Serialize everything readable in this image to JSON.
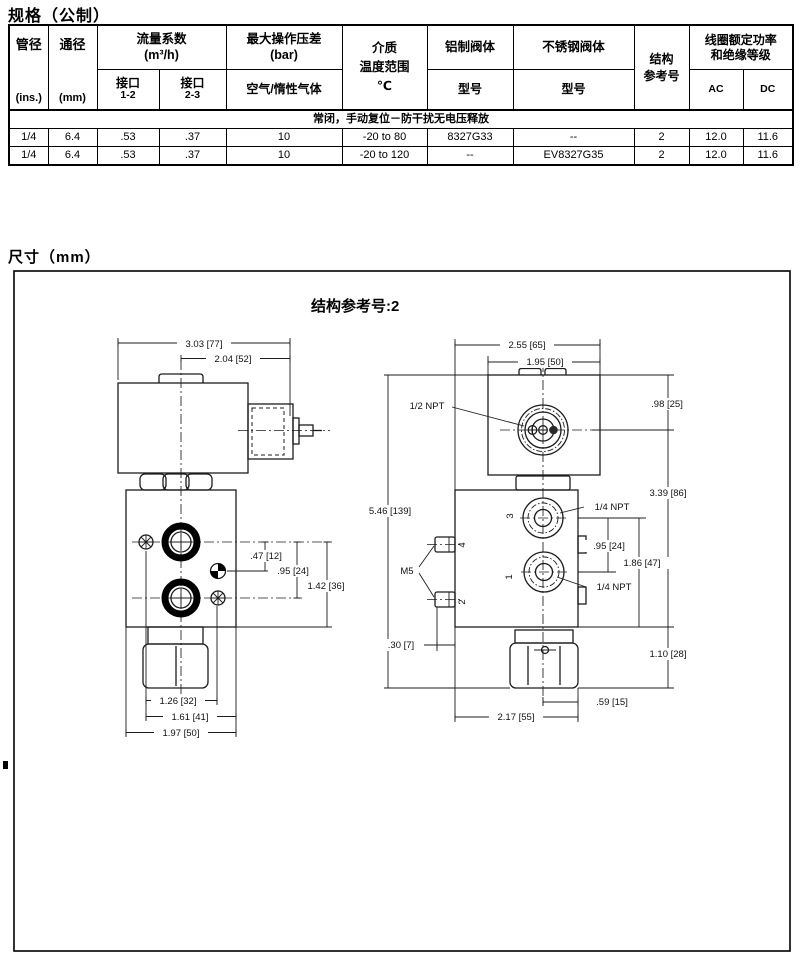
{
  "page": {
    "spec_title": "规格（公制）",
    "dim_title": "尺寸（mm）"
  },
  "table": {
    "header": {
      "pipe": {
        "top": "管径",
        "bottom": "(ins.)"
      },
      "orifice": {
        "top": "通径",
        "bottom": "(mm)"
      },
      "flow": {
        "title": "流量系数",
        "unit": "(m³/h)",
        "port12": {
          "l1": "接口",
          "l2": "1-2"
        },
        "port23": {
          "l1": "接口",
          "l2": "2-3"
        }
      },
      "pressure": {
        "title": "最大操作压差",
        "unit": "(bar)",
        "sub": "空气/惰性气体"
      },
      "media": {
        "l1": "介质",
        "l2": "温度范围",
        "l3": "℃"
      },
      "aluminum": {
        "title": "铝制阀体",
        "sub": "型号"
      },
      "stainless": {
        "title": "不锈钢阀体",
        "sub": "型号"
      },
      "construction": {
        "l1": "结构",
        "l2": "参考号"
      },
      "coil": {
        "l1": "线圈额定功率",
        "l2": "和绝缘等级",
        "ac": "AC",
        "dc": "DC"
      }
    },
    "group_row": "常闭，手动复位－防干扰无电压释放",
    "rows": [
      [
        "1/4",
        "6.4",
        ".53",
        ".37",
        "10",
        "-20 to 80",
        "8327G33",
        "--",
        "2",
        "12.0",
        "11.6"
      ],
      [
        "1/4",
        "6.4",
        ".53",
        ".37",
        "10",
        "-20 to 120",
        "--",
        "EV8327G35",
        "2",
        "12.0",
        "11.6"
      ]
    ]
  },
  "drawing": {
    "title": "结构参考号:2",
    "front": {
      "overall_width": "3.03 [77]",
      "coil_width": "2.04 [52]",
      "port_offset": ".47 [12]",
      "port_spacing": ".95 [24]",
      "port_to_bottom": "1.42 [36]",
      "screw_spacing": "1.26 [32]",
      "screw_to_edge": "1.61 [41]",
      "body_width": "1.97 [50]"
    },
    "side": {
      "overall_width": "2.55 [65]",
      "coil_width": "1.95 [50]",
      "coil_top_to_conduit": ".98 [25]",
      "conduit_to_bottom": "3.39 [86]",
      "overall_height": "5.46 [139]",
      "port_spacing": ".95 [24]",
      "port_to_bottom": "1.86 [47]",
      "mount_depth": ".30 [7]",
      "nut_height": "1.10 [28]",
      "center_to_edge": ".59 [15]",
      "body_depth": "2.17 [55]",
      "conduit": "1/2 NPT",
      "port3_thread": "1/4 NPT",
      "port1_thread": "1/4 NPT",
      "mount_thread": "M5",
      "port3": "3",
      "port1": "1",
      "port4": "4",
      "port2": "2"
    }
  }
}
